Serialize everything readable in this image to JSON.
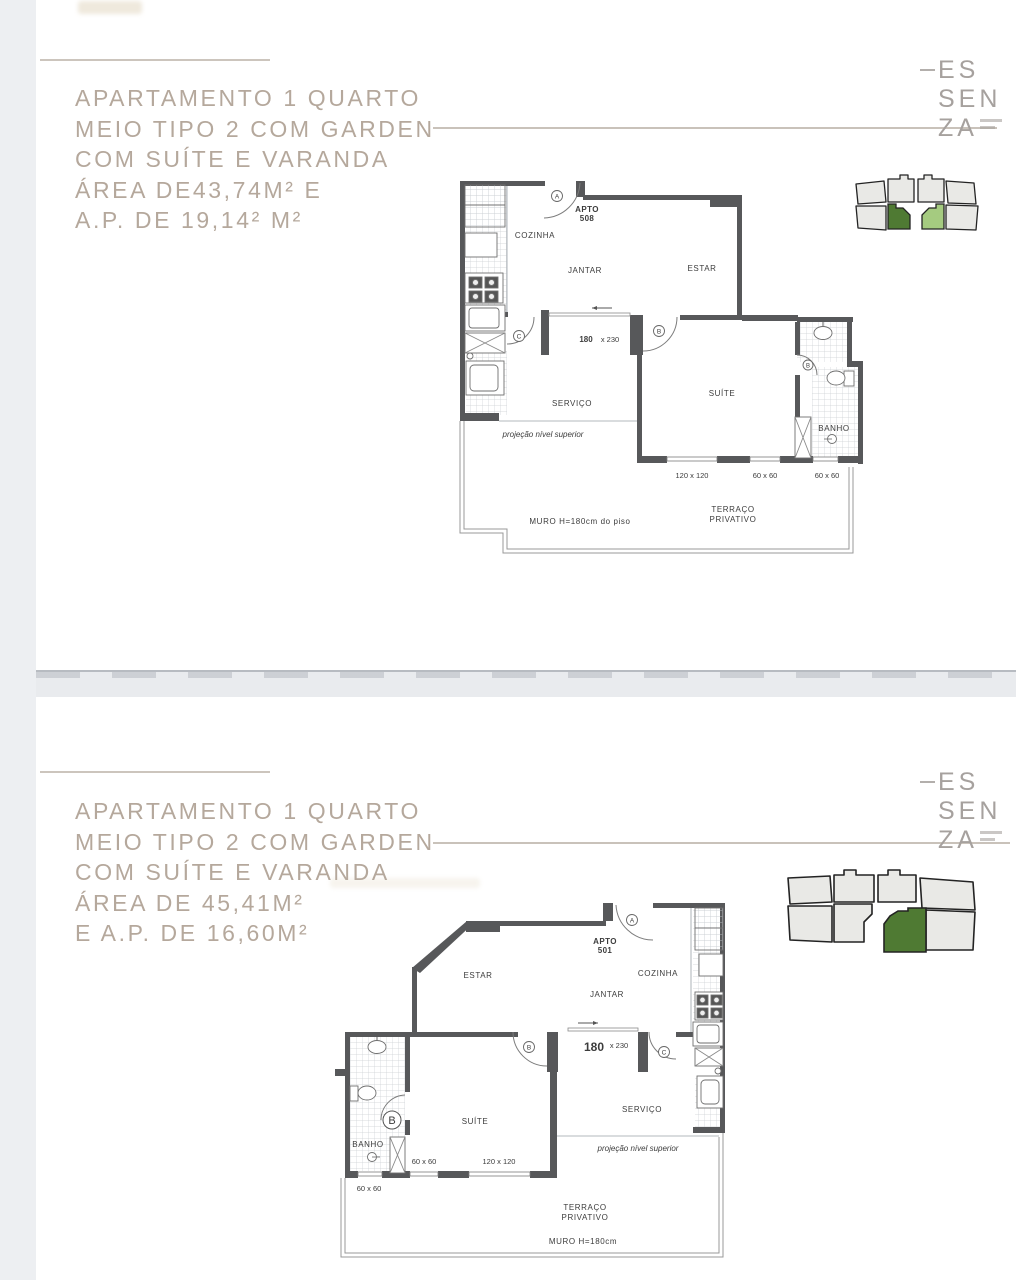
{
  "colors": {
    "page_bg": "#edeff2",
    "panel_bg": "#ffffff",
    "title_text": "#b5a89c",
    "logo_text": "#a6a19e",
    "plan_wall": "#57585a",
    "key_unit_fill": "#e9e9e6",
    "key_unit_stroke": "#232323",
    "key_green_dark": "#4f7a33",
    "key_green_light": "#a5cb80"
  },
  "panel_top": {
    "title": {
      "line1": "APARTAMENTO 1 QUARTO",
      "line2": "MEIO TIPO 2 COM GARDEN",
      "line3": "COM SUÍTE E VARANDA",
      "line4": "ÁREA DE43,74M² E",
      "line5": "A.P. DE 19,14² M²"
    },
    "logo": {
      "row1": "ES",
      "row2": "SEN",
      "row3": "ZA"
    },
    "plan": {
      "apto_label": "APTO",
      "apto_number": "508",
      "cozinha": "COZINHA",
      "jantar": "JANTAR",
      "estar": "ESTAR",
      "servico": "SERVIÇO",
      "suite": "SUÍTE",
      "banho": "BANHO",
      "door_a": "A",
      "door_b": "B",
      "door_c": "C",
      "door_bath": "B",
      "dim_door_w": "180",
      "dim_door_h": "x 230",
      "win_120": "120 x 120",
      "win_60a": "60 x 60",
      "win_60b": "60 x 60",
      "projecao": "projeção nível superior",
      "muro": "MURO H=180cm do piso",
      "terraco_1": "TERRAÇO",
      "terraco_2": "PRIVATIVO"
    }
  },
  "panel_bottom": {
    "title": {
      "line1": "APARTAMENTO 1 QUARTO",
      "line2": "MEIO TIPO 2 COM GARDEN",
      "line3": "COM SUÍTE E VARANDA",
      "line4": "ÁREA DE 45,41M²",
      "line5": "E A.P. DE 16,60M²"
    },
    "logo": {
      "row1": "ES",
      "row2": "SEN",
      "row3": "ZA"
    },
    "plan": {
      "apto_label": "APTO",
      "apto_number": "501",
      "cozinha": "COZINHA",
      "jantar": "JANTAR",
      "estar": "ESTAR",
      "servico": "SERVIÇO",
      "suite": "SUÍTE",
      "banho": "BANHO",
      "door_a": "A",
      "door_b": "B",
      "door_c": "C",
      "door_banho": "B",
      "dim_door_w": "180",
      "dim_door_h": "x 230",
      "win_120": "120 x 120",
      "win_60a": "60 x 60",
      "win_60b": "60 x 60",
      "projecao": "projeção nível superior",
      "muro": "MURO H=180cm",
      "terraco_1": "TERRAÇO",
      "terraco_2": "PRIVATIVO"
    }
  }
}
